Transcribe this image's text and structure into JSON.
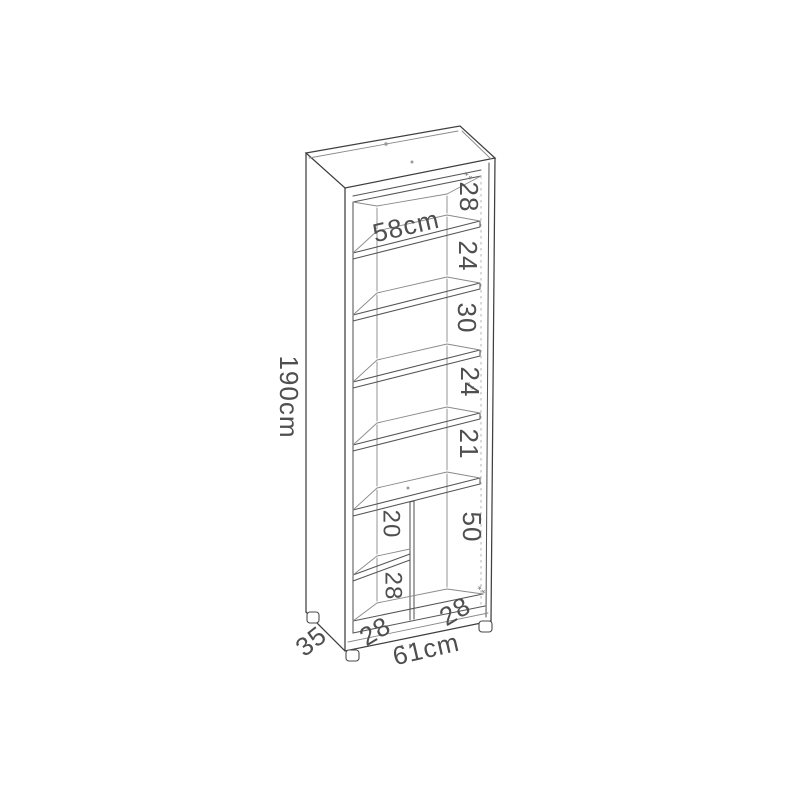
{
  "diagram": {
    "kind": "furniture-dimension-drawing",
    "object": "tall shelving unit / bookcase",
    "dimensions": {
      "height": "190cm",
      "width": "61cm",
      "depth": "35",
      "inner_width": "58cm",
      "right_gaps": [
        "28",
        "24",
        "30",
        "24",
        "21"
      ],
      "bottom_right_height": "50",
      "left_compartment_upper": "20",
      "left_compartment_lower": "28",
      "bottom_left_width": "28",
      "bottom_right_width": "28"
    },
    "decor_marks": [
      "**",
      "**",
      "**"
    ]
  }
}
